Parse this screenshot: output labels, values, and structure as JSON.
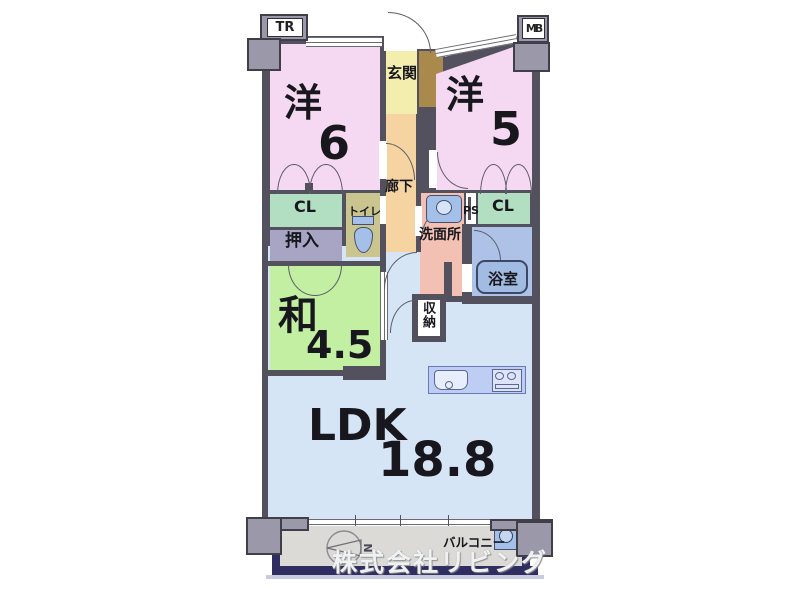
{
  "plan": {
    "rooms": {
      "western6": {
        "name": "洋",
        "area": "6"
      },
      "western5": {
        "name": "洋",
        "area": "5"
      },
      "japanese45": {
        "name": "和",
        "area": "4.5"
      },
      "ldk": {
        "name": "LDK",
        "area": "18.8"
      },
      "entrance": {
        "name": "玄関"
      },
      "hallway": {
        "name": "廊下"
      },
      "toilet": {
        "name": "トイレ"
      },
      "washroom": {
        "name": "洗面所"
      },
      "bathroom": {
        "name": "浴室"
      },
      "closet_left": {
        "name": "CL"
      },
      "closet_right": {
        "name": "CL"
      },
      "oshiire": {
        "name": "押入"
      },
      "storage": {
        "name": "収納"
      },
      "balcony": {
        "name": "バルコニー"
      }
    },
    "annotations": {
      "trunk_room": "TR",
      "meter_box": "MB",
      "pipe_space": "PS",
      "compass_north": "N",
      "watermark": "株式会社リビング"
    },
    "colors": {
      "wall": "#53515d",
      "pillar": "#9b99a9",
      "pink": "#f5d8f2",
      "yellow": "#f3edae",
      "brown": "#aa8a4c",
      "corridor": "#f6d4a2",
      "khaki": "#cac48e",
      "green": "#b2dfc2",
      "lavender": "#a7a5c3",
      "jgreen": "#c2efa1",
      "salmon": "#f3c1b4",
      "bathblue": "#adc2e6",
      "ldkblue": "#d6e5f6",
      "kitchenblue": "#becdf3",
      "balcony_gray": "#dbdad7",
      "navy": "#302e60",
      "fixture": "#a5c0e8"
    }
  }
}
